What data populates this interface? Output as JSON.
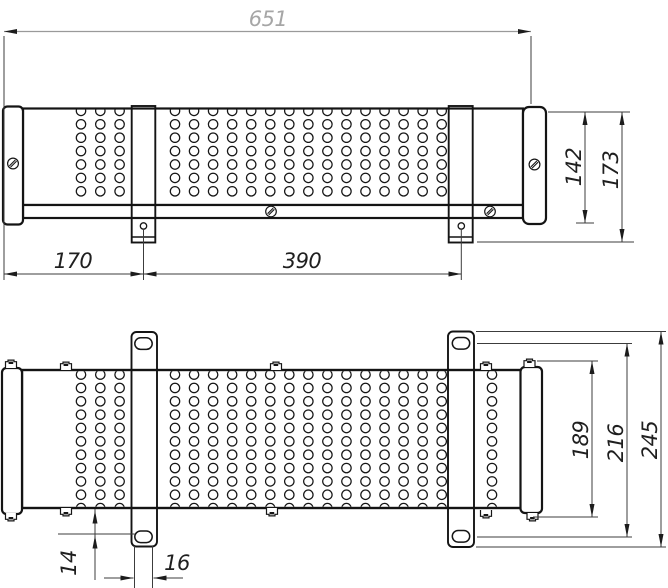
{
  "drawing": {
    "top_view": {
      "overall_length": "651",
      "left_section_length": "170",
      "mid_section_length": "390",
      "body_height": "142",
      "overall_height": "173"
    },
    "bottom_view": {
      "hole_edge_offset": "14",
      "slot_width": "16",
      "end_cap_length": "189",
      "slot_spacing": "216",
      "bracket_length": "245"
    },
    "colors": {
      "line": "#141414",
      "dim_line": "#3c3c3c",
      "dim_text": "#1f1f1f",
      "faded_dim": "#a6a6a6",
      "background": "#ffffff"
    }
  }
}
